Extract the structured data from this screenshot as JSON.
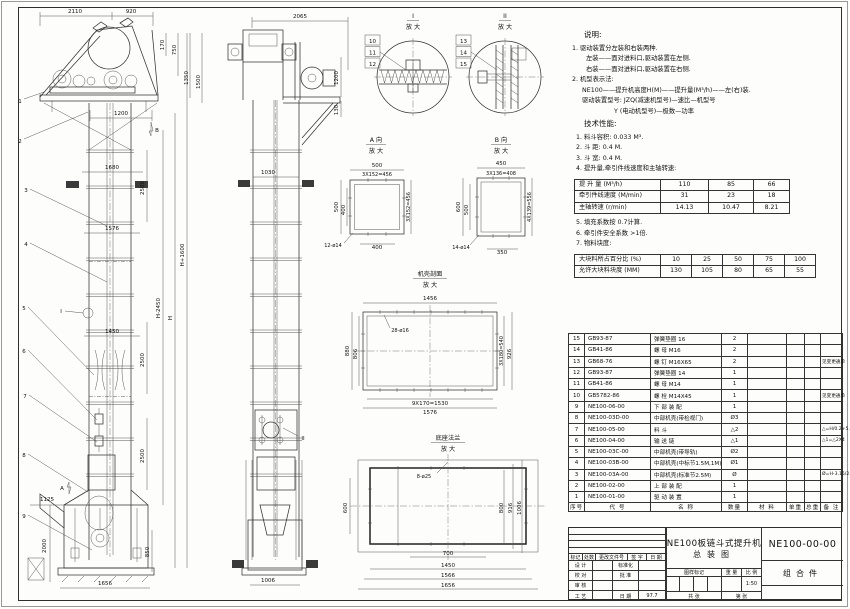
{
  "front_view": {
    "dims": {
      "top_left": "2110",
      "top_right": "920",
      "r170": "170",
      "r750": "750",
      "r1350": "1350",
      "r1500": "1500",
      "w1200": "1200",
      "w1680": "1680",
      "w1576": "1576",
      "w1450": "1450",
      "seg2500a": "2500",
      "seg2500b": "2500",
      "seg2500c": "2500",
      "h_plus": "H+1600",
      "h_minus": "H-2450",
      "h": "H",
      "w1125": "1125",
      "h2000": "2000",
      "h850": "850",
      "w1656": "1656"
    },
    "balloons": [
      "1",
      "2",
      "3",
      "4",
      "5",
      "6",
      "7",
      "8",
      "9"
    ],
    "marker_a": "A",
    "marker_b": "B",
    "marker_i": "I"
  },
  "side_view": {
    "dims": {
      "top": "2065",
      "r1200": "1200",
      "r130": "130",
      "w1030": "1030",
      "w1006": "1006"
    },
    "marker_ii": "II"
  },
  "detail_i": {
    "title": "I",
    "sub": "放 大",
    "balloons": [
      "10",
      "11",
      "12"
    ]
  },
  "detail_ii": {
    "title": "II",
    "sub": "放 大",
    "balloons": [
      "13",
      "14",
      "15"
    ]
  },
  "section_a": {
    "title": "A 向",
    "sub": "放 大",
    "dims": {
      "top": "500",
      "top2": "3X152=456",
      "left": "500",
      "left2": "400",
      "bottom": "400",
      "right": "3X152=456",
      "holes": "12-ø14"
    }
  },
  "section_b": {
    "title": "B 向",
    "sub": "放 大",
    "dims": {
      "top": "450",
      "top2": "3X136=408",
      "left": "600",
      "left2": "500",
      "bottom": "350",
      "right": "4X139=556",
      "holes": "14-ø14"
    }
  },
  "casing_section": {
    "title": "机壳剖面",
    "sub": "放 大",
    "dims": {
      "top": "1456",
      "left": "880",
      "left2": "806",
      "right": "3X180=540",
      "right2": "926",
      "bottom": "9X170=1530",
      "bottom2": "1576",
      "holes": "28-ø16"
    }
  },
  "base_section": {
    "title": "底座法兰",
    "sub": "放 大",
    "dims": {
      "left": "600",
      "right": "800",
      "right2": "916",
      "right3": "1006",
      "bottom": "700",
      "bottom2": "1450",
      "bottom3": "1566",
      "bottom4": "1656",
      "holes": "8-ø25"
    }
  },
  "notes": {
    "heading": "说明:",
    "lines": [
      "1. 驱动装置分左装和右装两种.",
      "左装——面对进料口,驱动装置在左侧.",
      "右装——面对进料口,驱动装置在右侧.",
      "2. 机型表示法:",
      "NE100——提升机高度H(M)——提升量(M³/h)——左(右)装.",
      "驱动装置型号: JZQ(减速机型号)—速比—机型号",
      "Y (电动机型号)—极数—功率"
    ]
  },
  "tech": {
    "heading": "技术性能:",
    "lines_before": [
      "1. 料斗容积: 0.033 M³.",
      "2. 斗  距: 0.4 M.",
      "3. 斗  宽: 0.4 M.",
      "4. 提升量,牵引件线速度和主轴转速:"
    ],
    "lines_after": [
      "5. 填充系数按 0.7计算.",
      "6. 牵引件安全系数 >1倍.",
      "7. 物料块度:"
    ]
  },
  "spec_speed": {
    "rows": [
      {
        "label": "提 升 量  (M³/h)",
        "values": [
          "110",
          "85",
          "66"
        ]
      },
      {
        "label": "牵引件线速度 (M/min)",
        "values": [
          "31",
          "23",
          "18"
        ]
      },
      {
        "label": "主轴转速 (r/min)",
        "values": [
          "14.13",
          "10.47",
          "8.21"
        ]
      }
    ]
  },
  "spec_lump": {
    "rows": [
      {
        "label": "大块料所占百分比 (%)",
        "values": [
          "10",
          "25",
          "50",
          "75",
          "100"
        ]
      },
      {
        "label": "允许大块料块度 (MM)",
        "values": [
          "130",
          "105",
          "80",
          "65",
          "55"
        ]
      }
    ]
  },
  "bom": {
    "headers": [
      "序号",
      "代  号",
      "名  称",
      "数量",
      "材  料",
      "单重",
      "总重",
      "备 注"
    ],
    "rows": [
      {
        "no": "15",
        "code": "GB93-87",
        "name": "弹簧垫圈 16",
        "qty": "2",
        "remark": ""
      },
      {
        "no": "14",
        "code": "GB41-86",
        "name": "螺 母  M16",
        "qty": "2",
        "remark": ""
      },
      {
        "no": "13",
        "code": "GB68-76",
        "name": "螺 钉  M16X65",
        "qty": "2",
        "remark": "见变更通单"
      },
      {
        "no": "12",
        "code": "GB93-87",
        "name": "弹簧垫圈 14",
        "qty": "1",
        "remark": ""
      },
      {
        "no": "11",
        "code": "GB41-86",
        "name": "螺 母  M14",
        "qty": "1",
        "remark": ""
      },
      {
        "no": "10",
        "code": "GB5782-86",
        "name": "螺 栓  M14X45",
        "qty": "1",
        "remark": "见变更通单"
      },
      {
        "no": "9",
        "code": "NE100-06-00",
        "name": "下 部 装 配",
        "qty": "1",
        "remark": ""
      },
      {
        "no": "8",
        "code": "NE100-03D-00",
        "name": "中部机壳(带检视门)",
        "qty": "Ø3",
        "remark": ""
      },
      {
        "no": "7",
        "code": "NE100-05-00",
        "name": "料 斗",
        "qty": "△2",
        "remark": "△=H/0.2+5.75"
      },
      {
        "no": "6",
        "code": "NE100-04-00",
        "name": "输 送 链",
        "qty": "△1",
        "remark": "△1=△2X4"
      },
      {
        "no": "5",
        "code": "NE100-03C-00",
        "name": "中部机壳(带导轨)",
        "qty": "Ø2",
        "remark": ""
      },
      {
        "no": "4",
        "code": "NE100-03B-00",
        "name": "中部机壳(中标节1.5M,1M)",
        "qty": "Ø1",
        "remark": ""
      },
      {
        "no": "3",
        "code": "NE100-03A-00",
        "name": "中部机壳(标准节2.5M)",
        "qty": "Ø",
        "remark": "Ø=H-3.15/2.5"
      },
      {
        "no": "2",
        "code": "NE100-02-00",
        "name": "上 部 装 配",
        "qty": "1",
        "remark": ""
      },
      {
        "no": "1",
        "code": "NE100-01-00",
        "name": "驱 动 装 置",
        "qty": "1",
        "remark": ""
      }
    ]
  },
  "titleblock": {
    "title_line1": "NE100板链斗式提升机",
    "title_line2": "总装图",
    "drawing_no": "NE100-00-00",
    "part_type": "组合件",
    "rev_headers": [
      "标记",
      "处数",
      "更改文件号",
      "签 字",
      "日 期"
    ],
    "sig_rows": [
      {
        "l": "设 计",
        "r": "标准化",
        "v": ""
      },
      {
        "l": "校 对",
        "r": "批 准",
        "v": ""
      },
      {
        "l": "审 核",
        "r": "",
        "v": ""
      },
      {
        "l": "工 艺",
        "r": "日 期",
        "v": "97.7"
      }
    ],
    "mid_headers": [
      "图样标记",
      "重 量",
      "比 例"
    ],
    "scale": "1:50",
    "sheet_label_1": "共  张",
    "sheet_label_2": "第  张"
  }
}
